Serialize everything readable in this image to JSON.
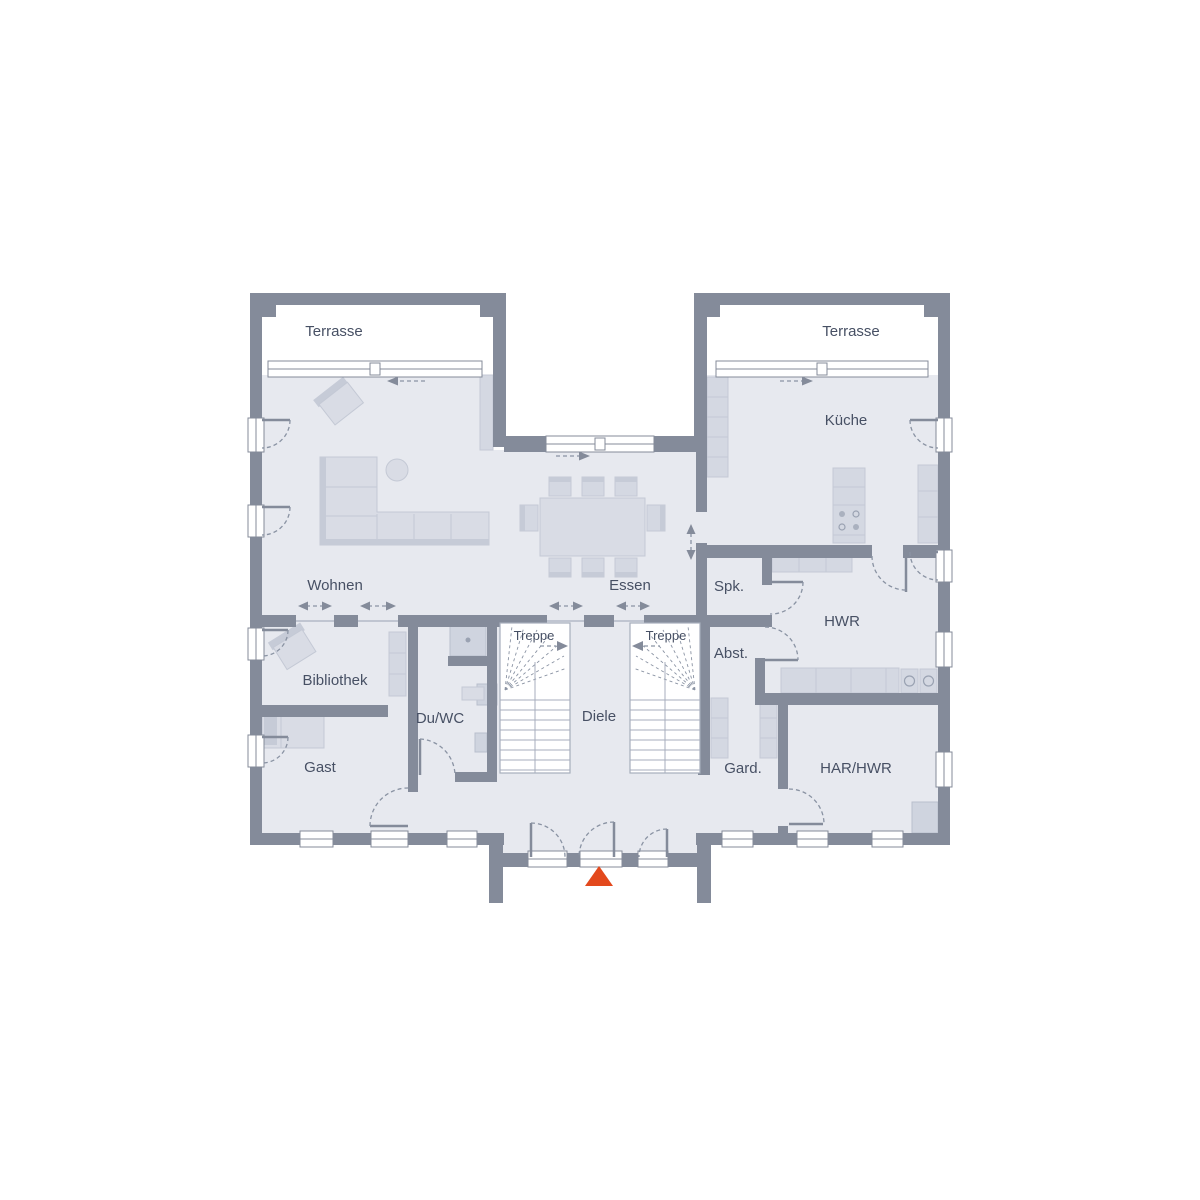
{
  "labels": {
    "terrasse_left": "Terrasse",
    "terrasse_right": "Terrasse",
    "kueche": "Küche",
    "wohnen": "Wohnen",
    "essen": "Essen",
    "spk": "Spk.",
    "hwr": "HWR",
    "treppe_left": "Treppe",
    "treppe_right": "Treppe",
    "abst": "Abst.",
    "bibliothek": "Bibliothek",
    "duwc": "Du/WC",
    "diele": "Diele",
    "gast": "Gast",
    "gard": "Gard.",
    "harhwr": "HAR/HWR"
  },
  "colors": {
    "wall": "#848b9a",
    "floor": "#e7e9ef",
    "furn": "#d9dce5",
    "furnAlt": "#d4d8e2",
    "furnBorder": "#c4c9d5",
    "furnDark": "#c6cbd7",
    "fixture": "#cfd4df",
    "tread": "#a7aebc",
    "dash": "#8a93a3",
    "text": "#475064",
    "marker": "#e3491d"
  }
}
